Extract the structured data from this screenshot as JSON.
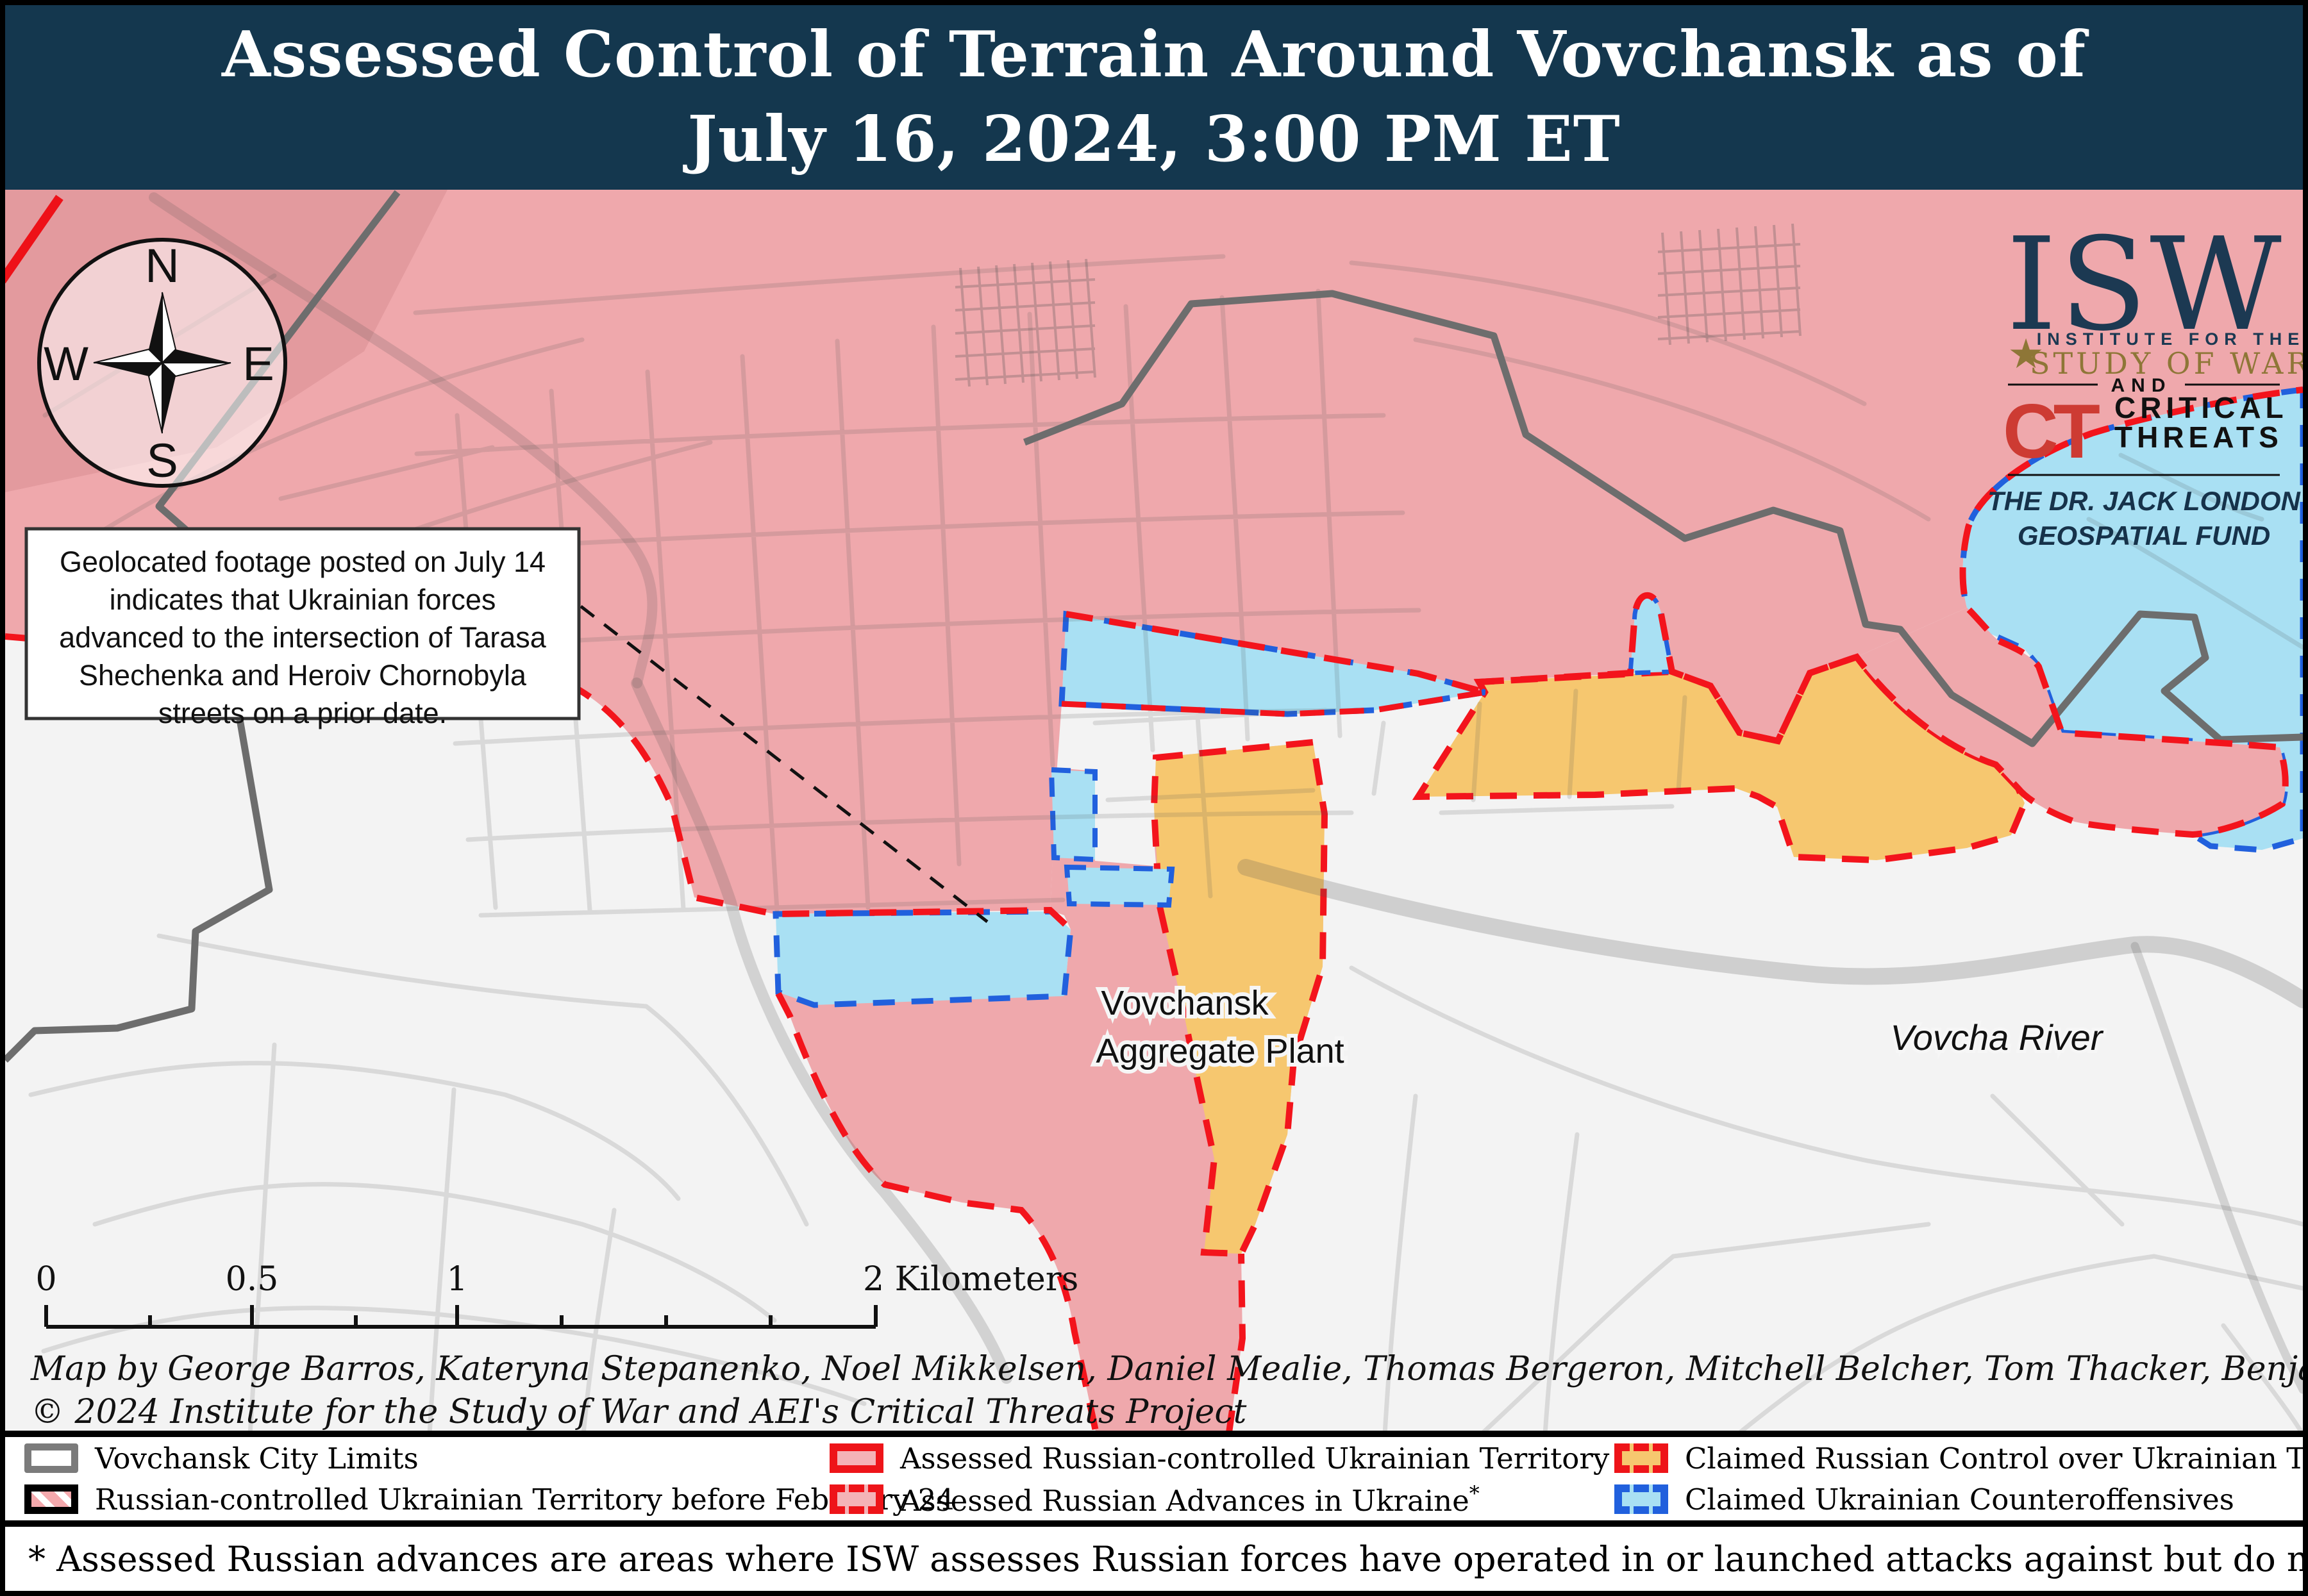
{
  "title": {
    "line1": "Assessed Control of Terrain Around Vovchansk as of",
    "line2": "July 16, 2024, 3:00 PM ET"
  },
  "compass": {
    "north": "N",
    "east": "E",
    "south": "S",
    "west": "W"
  },
  "callout": {
    "lines": [
      "Geolocated footage posted on July 14",
      "indicates that Ukrainian forces",
      "advanced to the intersection of Tarasa",
      "Shechenka and Heroiv Chornobyla",
      "streets on a prior date."
    ]
  },
  "logo": {
    "isw": "ISW",
    "star": "★",
    "institute": "INSTITUTE FOR THE",
    "study": "STUDY OF WAR",
    "and": "AND",
    "ct": "CT",
    "critical": "CRITICAL",
    "threats": "THREATS",
    "fund_line1": "THE DR. JACK LONDON",
    "fund_line2": "GEOSPATIAL FUND"
  },
  "map_labels": {
    "plant_line1": "Vovchansk",
    "plant_line2": "Aggregate Plant",
    "river": "Vovcha River"
  },
  "scale_bar": {
    "labels": [
      "0",
      "0.5",
      "1",
      "2 Kilometers"
    ]
  },
  "credits": {
    "line1": "Map by George Barros, Kateryna Stepanenko, Noel Mikkelsen, Daniel Mealie, Thomas Bergeron, Mitchell Belcher, Tom Thacker, Benjamin Cordola, and Harrison Hurwitz",
    "line2": "© 2024 Institute for the Study of War and AEI's Critical Threats Project"
  },
  "legend": {
    "asterisk": "*",
    "items": [
      {
        "label": "Vovchansk City Limits"
      },
      {
        "label": "Russian-controlled Ukrainian Territory before February 24"
      },
      {
        "label": "Assessed Russian-controlled Ukrainian Territory"
      },
      {
        "label": "Assessed Russian Advances in Ukraine"
      },
      {
        "label": "Claimed Russian Control over Ukrainian Territory"
      },
      {
        "label": "Claimed Ukrainian Counteroffensives"
      }
    ]
  },
  "footnote": "* Assessed Russian advances are areas where ISW assesses Russian forces have operated in or launched attacks against but do not control.",
  "colors": {
    "header": "#14374e",
    "russian_controlled": "#efa8ac",
    "claimed_russian": "#f6c76f",
    "claimed_ukrainian": "#a9e0f3",
    "red_dash": "#f3141c",
    "blue_dash": "#2160dd",
    "map_background": "#f3f3f3",
    "city_limits_gray": "#6d6d6d"
  }
}
